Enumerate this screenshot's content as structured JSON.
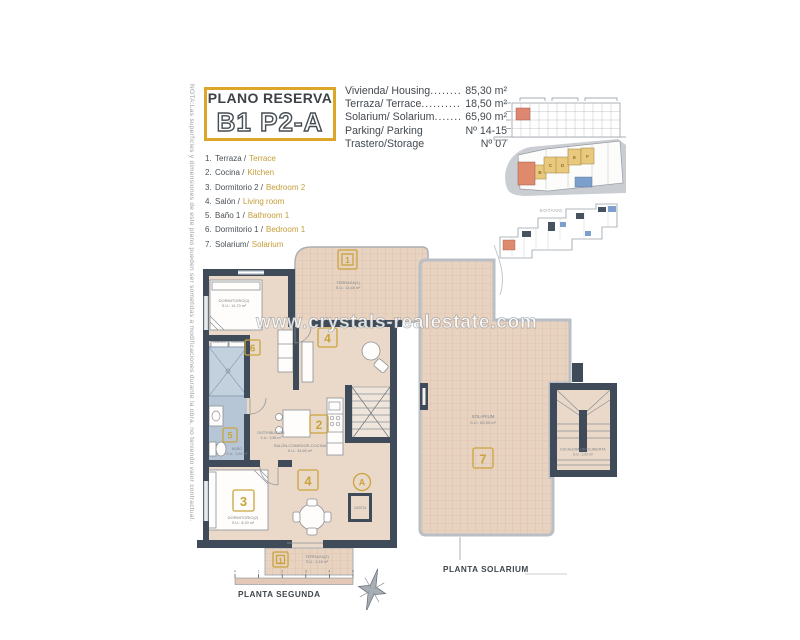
{
  "note": "NOTA:Las superficies y dimensiones de este plano pueden ser sometidas a modificaciones durante la obra, no teniendo valor contractual.",
  "title": {
    "kicker": "PLANO RESERVA",
    "code": "B1 P2-A"
  },
  "info": {
    "rows": [
      {
        "label": "Vivienda/ Housing",
        "dots": "..............................",
        "value": "85,30 m²"
      },
      {
        "label": "Terraza/ Terrace",
        "dots": "..............................",
        "value": "18,50 m²"
      },
      {
        "label": "Solarium/ Solarium",
        "dots": "..............................",
        "value": "65,90 m²"
      },
      {
        "label": "Parking/ Parking",
        "dots": "",
        "value": "Nº 14-15"
      },
      {
        "label": "Trastero/Storage",
        "dots": "",
        "value": "Nº 07"
      }
    ]
  },
  "legend": [
    {
      "num": "1.",
      "es": "Terraza /",
      "en": "Terrace"
    },
    {
      "num": "2.",
      "es": "Cocina /",
      "en": "Kitchen"
    },
    {
      "num": "3.",
      "es": "Dormitorio 2 /",
      "en": "Bedroom 2"
    },
    {
      "num": "4.",
      "es": "Salón /",
      "en": "Living room"
    },
    {
      "num": "5.",
      "es": "Baño 1 /",
      "en": "Bathroom 1"
    },
    {
      "num": "6.",
      "es": "Dormitorio 1 /",
      "en": "Bedroom 1"
    },
    {
      "num": "7.",
      "es": "Solarium/",
      "en": "Solarium"
    }
  ],
  "watermark": "www.crystals-realestate.com",
  "plan2": {
    "label": "PLANTA SEGUNDA",
    "scale": [
      "0",
      "1",
      "2",
      "3",
      "4",
      "5"
    ],
    "badge_terrace_top": "1",
    "badge_bed1": "6",
    "badge_bath": "5",
    "badge_bed2": "3",
    "badge_living_a": "4",
    "badge_living_b": "4",
    "badge_kitchen": "2",
    "badge_terrace_bottom": "1",
    "marker_section": "A",
    "terrace_top_name": "TERRAZA(1)",
    "terrace_top_area": "S.U.: 14,48 m²",
    "bed1_name": "DORMITORIO(1)",
    "bed1_area": "S.U.: 14,70 m²",
    "closet_a": "ARMARIO",
    "closet_b": "ARMARIO",
    "bath_name": "BAÑO",
    "bath_area": "S.U.: 3,85 m²",
    "hall_name": "DISTRIBUIDOR",
    "hall_area": "S.U.: 3,58 m²",
    "bed2_name": "DORMITORIO(2)",
    "bed2_area": "S.U.: 8,20 m²",
    "living_name": "SALÓN-COMEDOR-COCINA",
    "living_area": "S.U.: 34,60 m²",
    "terrace_bottom_name": "TERRAZA(2)",
    "terrace_bottom_area": "S.U.: 4,16 m²",
    "caseta_name": "CASETA"
  },
  "solarium": {
    "label": "PLANTA SOLARIUM",
    "badge": "7",
    "room_name": "SOLARIUM",
    "room_area": "S.U.: 65,90 m²",
    "stair_name": "ESCALERA DESCUBIERTA",
    "stair_area": "S.U.: 1,02 m²"
  },
  "minis": {
    "sotano": "SOTANO",
    "units": [
      "B",
      "C",
      "D",
      "E",
      "F"
    ]
  },
  "colors": {
    "accent_gold": "#dca728",
    "wall_dark": "#3f4b58",
    "floor_tan": "#e9d6c5",
    "bath_blue": "#b7c6d6",
    "unit_red": "#e08a6d"
  }
}
